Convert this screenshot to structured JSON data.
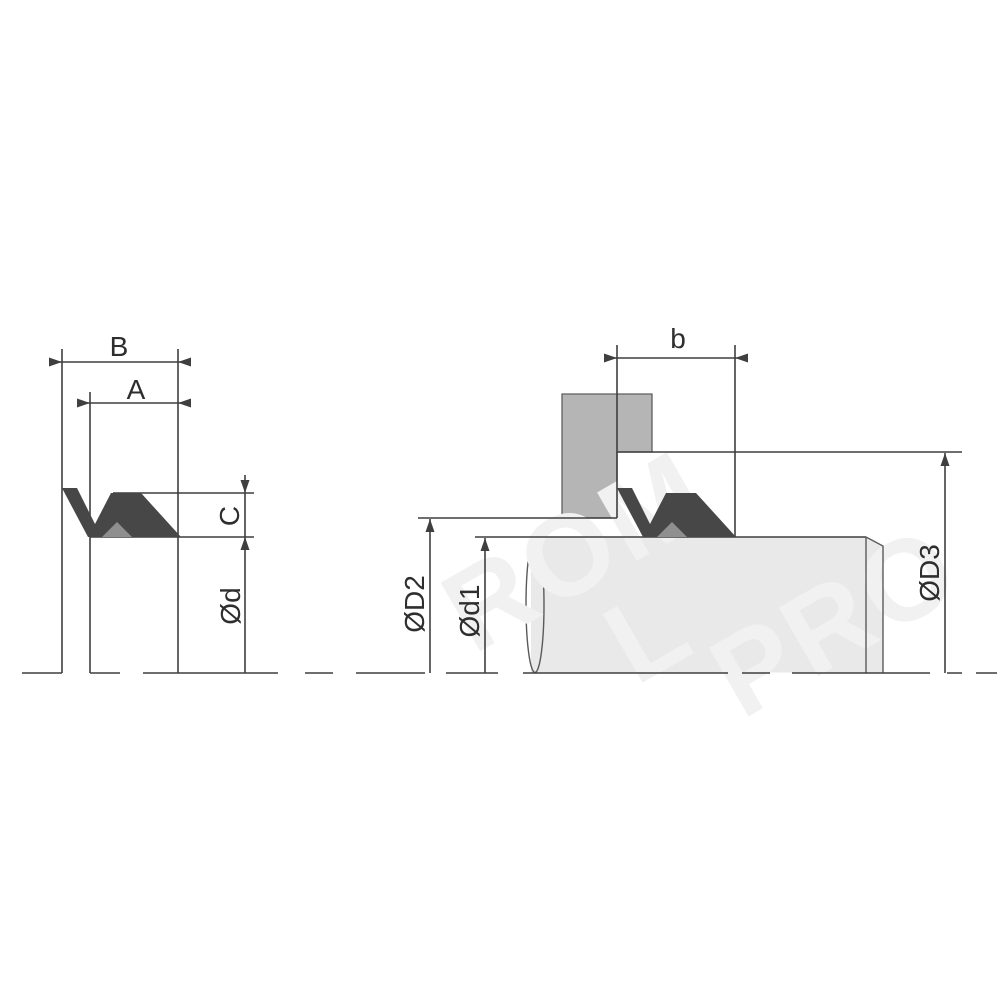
{
  "drawing": {
    "type": "seal-cross-section-and-installation",
    "left_view": {
      "dim_outer_width": "B",
      "dim_inner_width": "A",
      "dim_height": "C",
      "dim_inner_diameter": "Ød"
    },
    "right_view": {
      "dim_groove_width": "b",
      "dim_housing_bore": "ØD2",
      "dim_shaft_diameter": "Ød1",
      "dim_shoulder_diameter": "ØD3"
    },
    "watermark": {
      "fragments": [
        "ROM",
        "L",
        "PRO"
      ]
    },
    "colors": {
      "line": "#3f3f3f",
      "label_text": "#2e2e2e",
      "seal": "#474747",
      "seal_accent": "#8f8f8f",
      "housing": "#b5b5b5",
      "shaft": "#e9e9e9",
      "watermark": "#f1f1f1"
    }
  }
}
